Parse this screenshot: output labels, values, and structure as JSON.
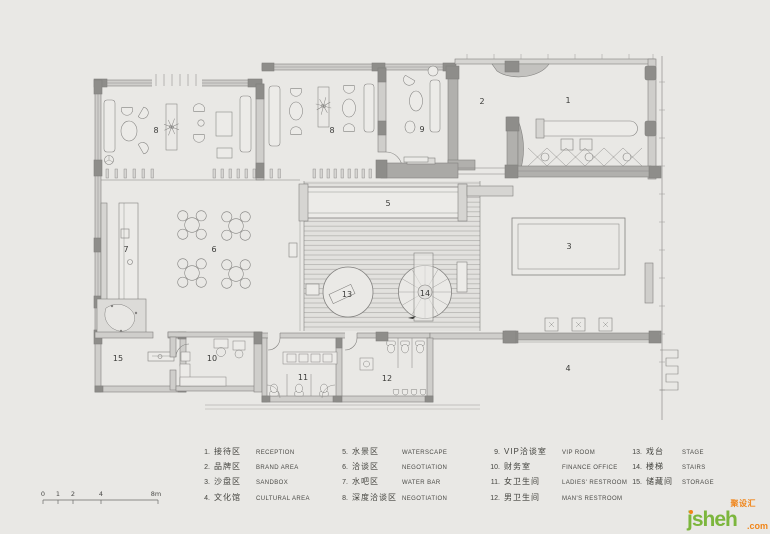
{
  "plan": {
    "labels": {
      "r1": "1",
      "r2": "2",
      "r3": "3",
      "r4": "4",
      "r5": "5",
      "r6": "6",
      "r7": "7",
      "r8a": "8",
      "r8b": "8",
      "r9": "9",
      "r10": "10",
      "r11": "11",
      "r12": "12",
      "r13": "13",
      "r14": "14",
      "r15": "15"
    }
  },
  "legend": {
    "items": [
      {
        "num": "1.",
        "cn": "接待区",
        "en": "RECEPTION"
      },
      {
        "num": "2.",
        "cn": "品牌区",
        "en": "BRAND AREA"
      },
      {
        "num": "3.",
        "cn": "沙盘区",
        "en": "SANDBOX"
      },
      {
        "num": "4.",
        "cn": "文化馆",
        "en": "CULTURAL AREA"
      },
      {
        "num": "5.",
        "cn": "水景区",
        "en": "WATERSCAPE"
      },
      {
        "num": "6.",
        "cn": "洽谈区",
        "en": "NEGOTIATION"
      },
      {
        "num": "7.",
        "cn": "水吧区",
        "en": "WATER BAR"
      },
      {
        "num": "8.",
        "cn": "深度洽谈区",
        "en": "NEGOTIATION"
      },
      {
        "num": "9.",
        "cn": "VIP洽谈室",
        "en": "VIP ROOM"
      },
      {
        "num": "10.",
        "cn": "财务室",
        "en": "FINANCE OFFICE"
      },
      {
        "num": "11.",
        "cn": "女卫生间",
        "en": "LADIES' RESTROOM"
      },
      {
        "num": "12.",
        "cn": "男卫生间",
        "en": "MAN'S RESTROOM"
      },
      {
        "num": "13.",
        "cn": "戏台",
        "en": "STAGE"
      },
      {
        "num": "14.",
        "cn": "楼梯",
        "en": "STAIRS"
      },
      {
        "num": "15.",
        "cn": "储藏间",
        "en": "STORAGE"
      }
    ]
  },
  "scale_bar": {
    "labels": [
      "0",
      "1",
      "2",
      "4",
      "8m"
    ]
  },
  "logo": {
    "name": "jsheh",
    "tld": ".com",
    "cn": "聚设汇"
  },
  "colors": {
    "background": "#e9e8e5",
    "wall": "#b1b0ad",
    "wall_dark": "#8e8d8a",
    "line": "#82817f",
    "logo_green": "#7cb63d",
    "logo_orange": "#f08519"
  }
}
